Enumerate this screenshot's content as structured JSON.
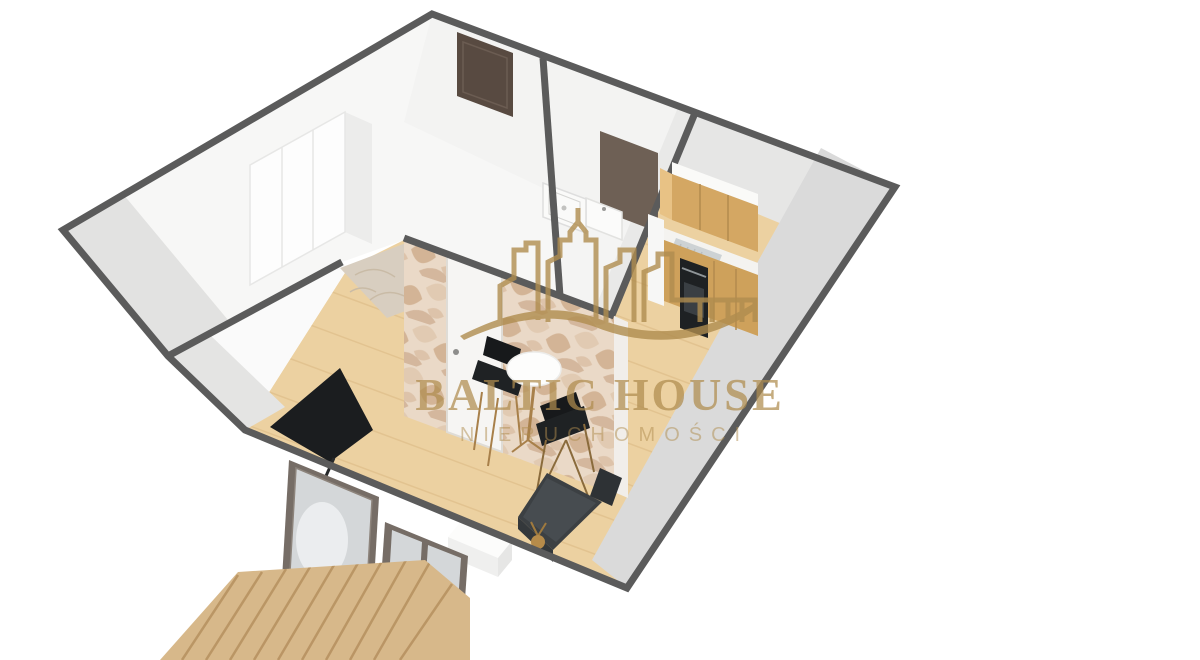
{
  "watermark": {
    "brand_line1": "BALTIC HOUSE",
    "brand_line2": "NIERUCHOMOŚCI",
    "icon": "city-skyline-with-wave"
  },
  "scene": {
    "type": "3d-floor-plan-render",
    "objects": [
      "hallway",
      "wardrobe",
      "entry-door",
      "bathroom",
      "shower-tray",
      "vanity-sink",
      "mirror-panel",
      "feature-wallpaper-wall",
      "bathroom-door",
      "living-room",
      "kitchen-cabinets",
      "sink",
      "oven",
      "dining-table",
      "two-chairs",
      "tv",
      "sofa-bed",
      "nightstand",
      "balcony-door",
      "window",
      "balcony-deck"
    ]
  },
  "colors": {
    "gold": "#b08d4f",
    "edge": "#5b5b5b",
    "floor": "#ecd1a1",
    "floor_line": "#dcba85",
    "cab": "#d4a763",
    "cab_dark": "#b38a4e",
    "deck": "#d7b88a",
    "deck_line": "#b6905f",
    "wp_base": "#ead9c7",
    "leaf1": "#cfae8d",
    "leaf2": "#dfc7ad",
    "leaf3": "#c09a79",
    "door_dark": "#584a41",
    "mirror": "#6e6055",
    "tv": "#1b1d1f",
    "sofa": "#3c4043",
    "marble": "#d8cec0",
    "glass": "#d4d7d9",
    "frame": "#766d66",
    "wall_gray": "#dadada"
  }
}
